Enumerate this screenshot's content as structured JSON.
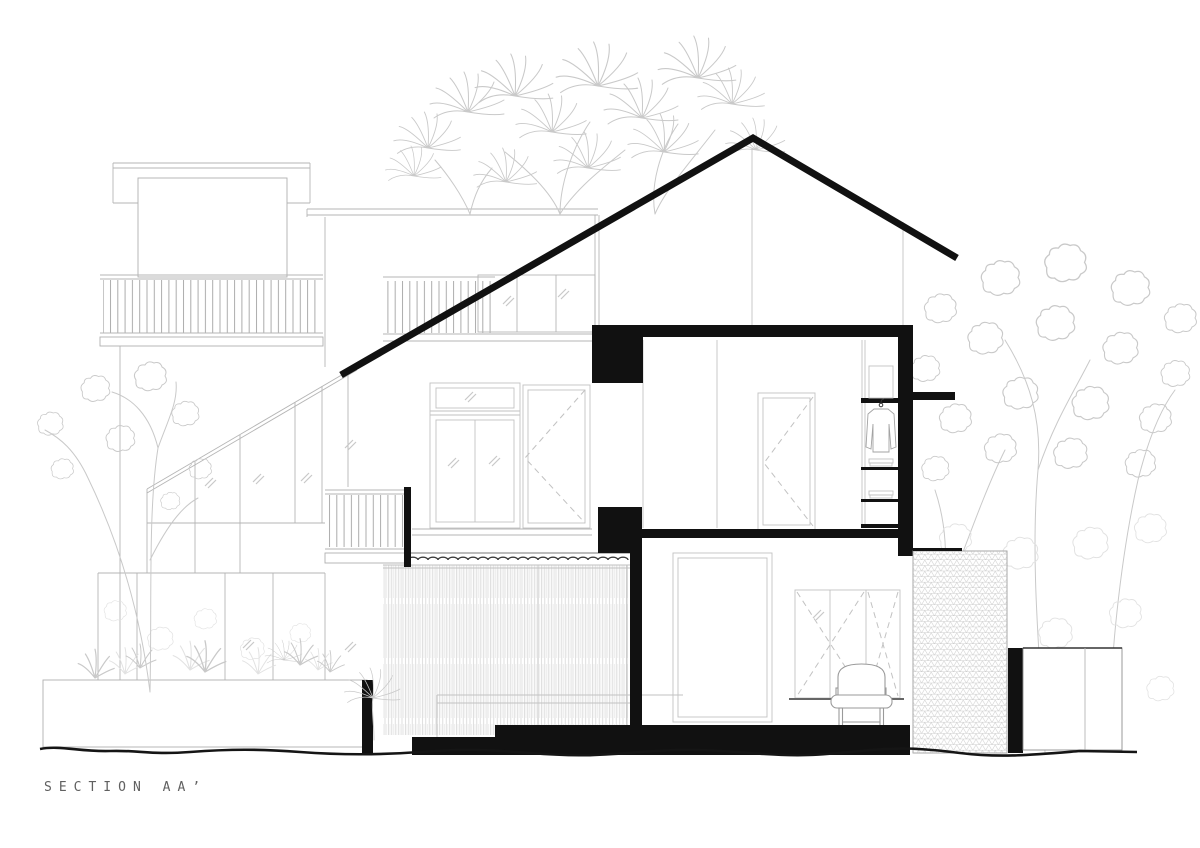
{
  "page": {
    "background": "#ffffff"
  },
  "titleblock": {
    "title": "SECTION AA’"
  },
  "palette": {
    "ink": "#111111",
    "outline": "#9a9a9a",
    "light": "#c6c6c6",
    "faint": "#e2e2e2",
    "title": "#606060",
    "bg": "#ffffff"
  }
}
